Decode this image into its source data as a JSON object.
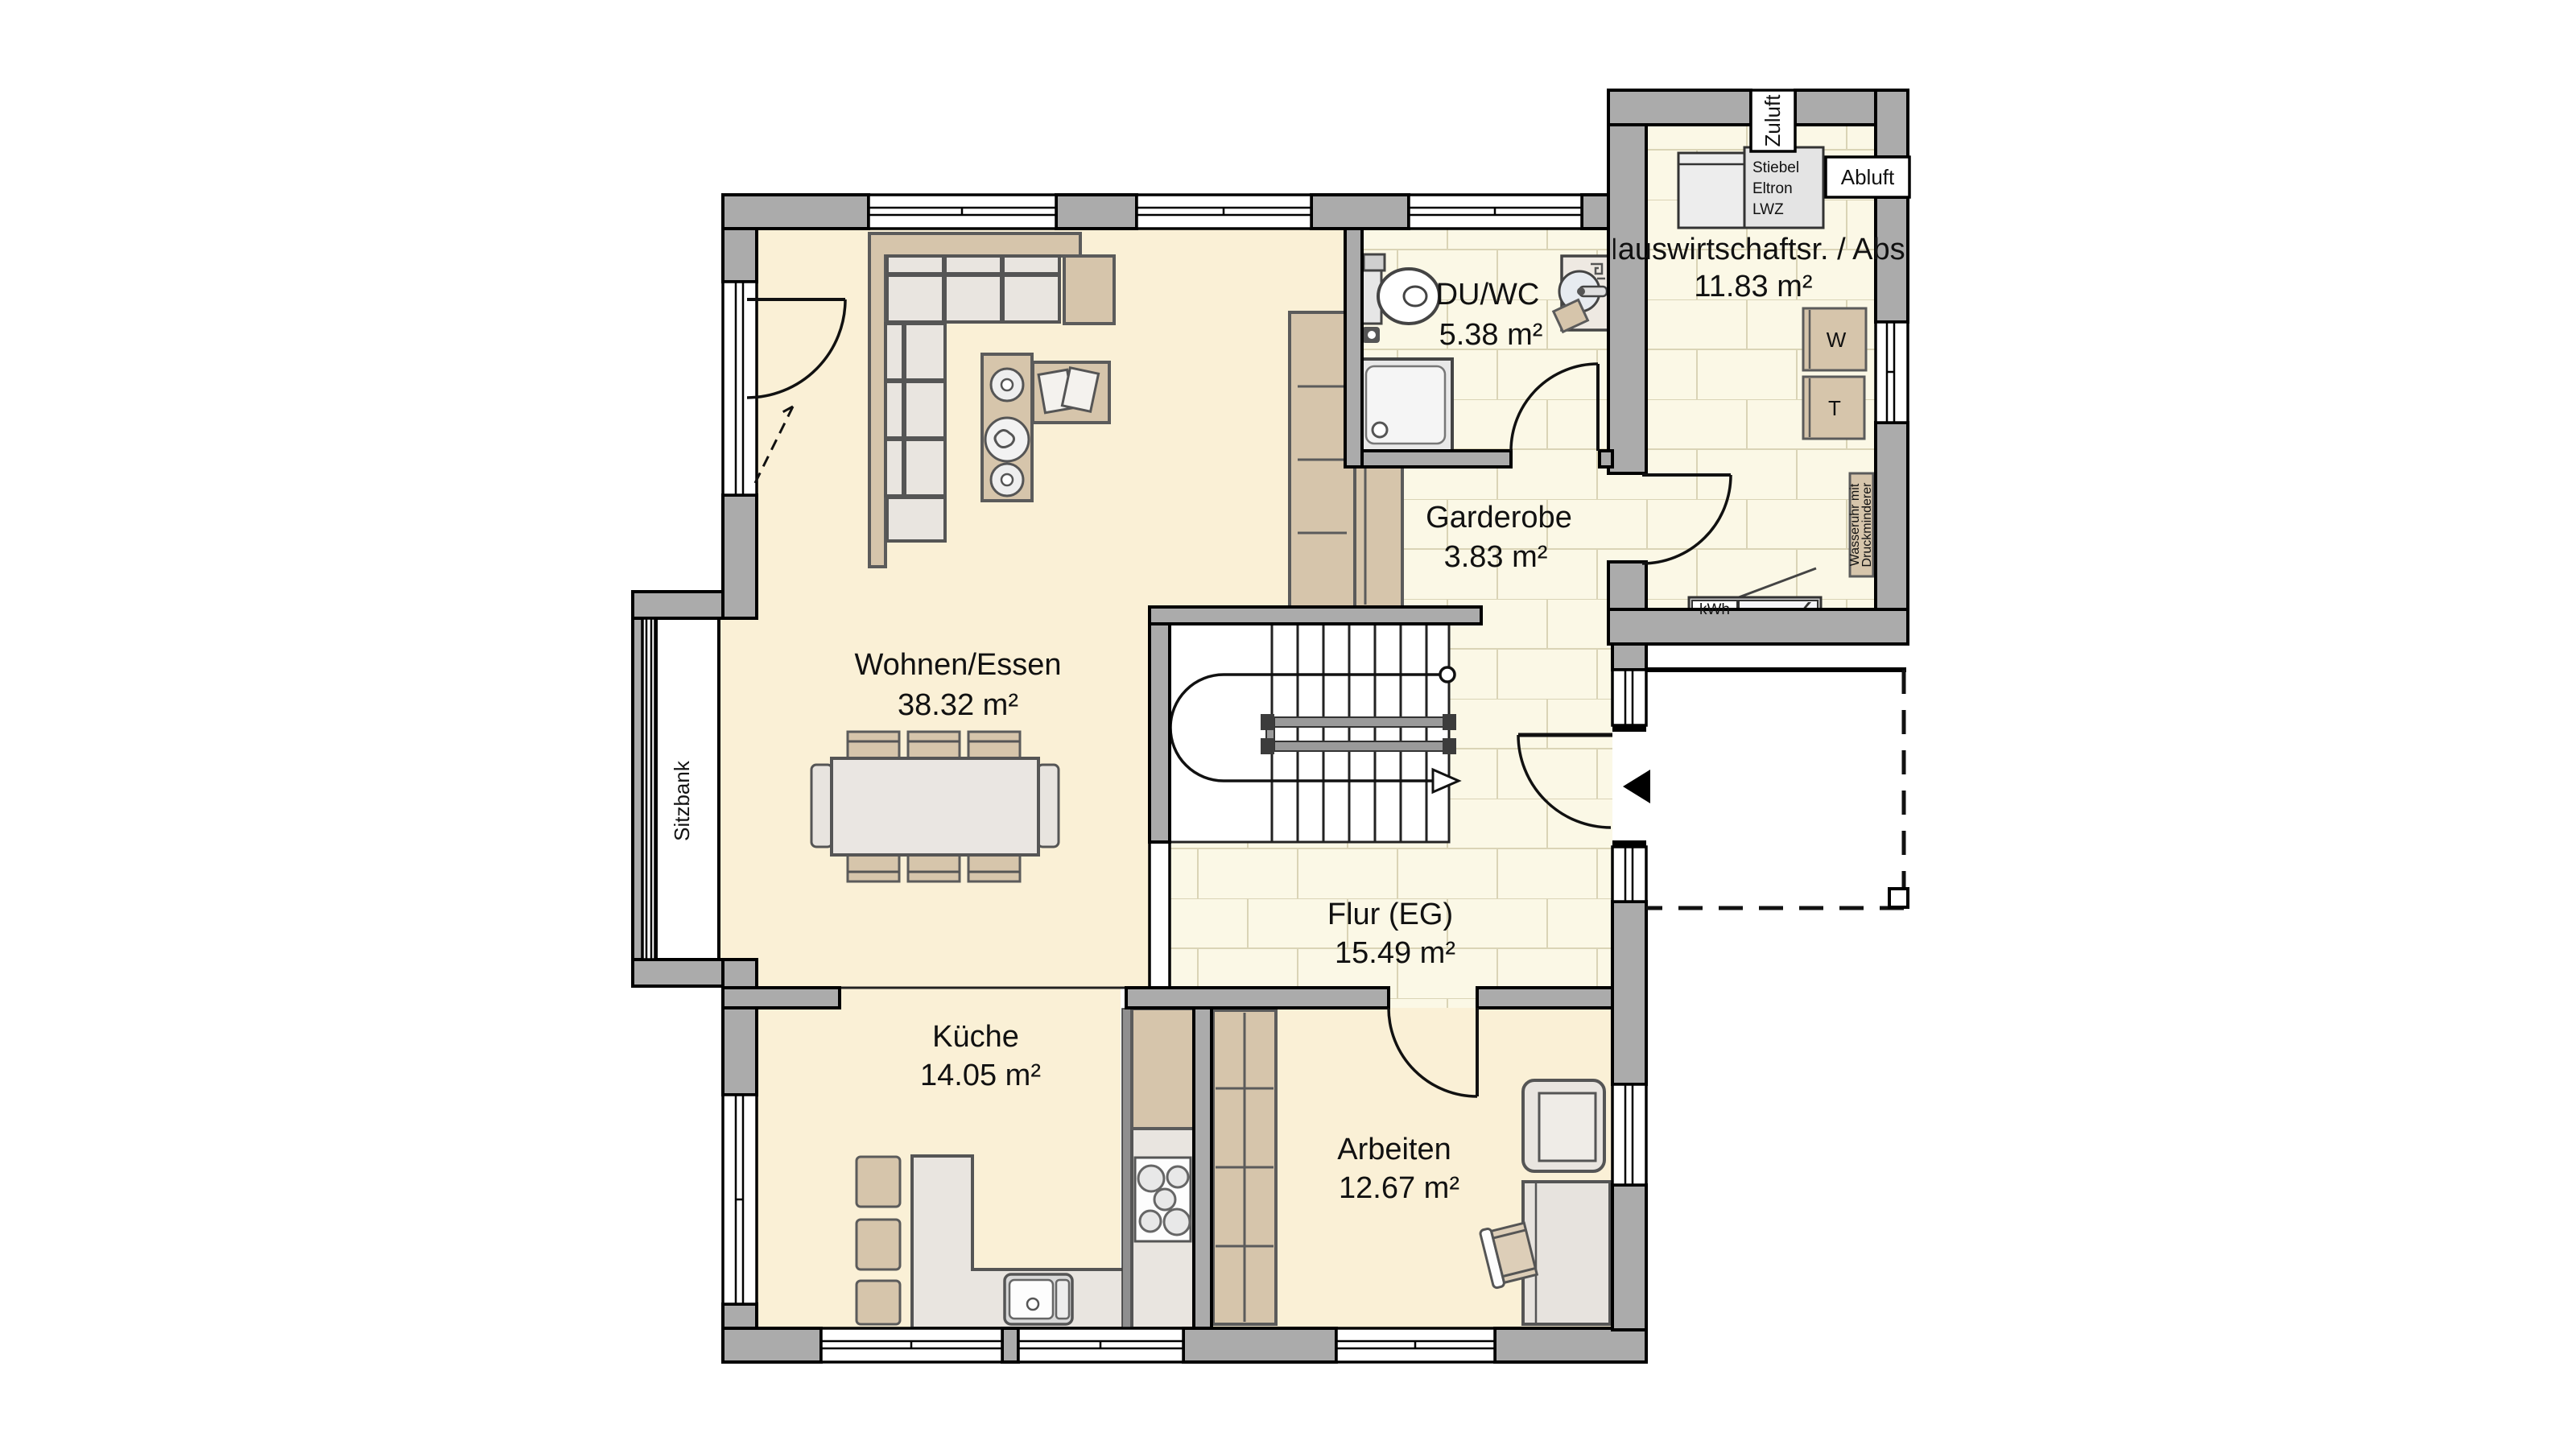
{
  "rooms": [
    {
      "id": "wohnen",
      "name": "Wohnen/Essen",
      "area": "38.32 m²"
    },
    {
      "id": "duwc",
      "name": "DU/WC",
      "area": "5.38 m²"
    },
    {
      "id": "hwr",
      "name": "Hauswirtschaftsr. / Abst.",
      "area": "11.83 m²"
    },
    {
      "id": "garderobe",
      "name": "Garderobe",
      "area": "3.83 m²"
    },
    {
      "id": "flur",
      "name": "Flur (EG)",
      "area": "15.49 m²"
    },
    {
      "id": "kueche",
      "name": "Küche",
      "area": "14.05 m²"
    },
    {
      "id": "arbeiten",
      "name": "Arbeiten",
      "area": "12.67 m²"
    }
  ],
  "annotations": {
    "sitzbank": "Sitzbank",
    "zuluft": "Zuluft",
    "abluft": "Abluft",
    "lwz0": "Stiebel",
    "lwz1": "Eltron",
    "lwz2": "LWZ",
    "kwh": "kWh",
    "washer": "W",
    "dryer": "T",
    "wasseruhr0": "Wasseruhr mit",
    "wasseruhr1": "Druckminderer"
  },
  "colors": {
    "wall": "#ABABAB",
    "cream": "#FAF0D6",
    "tile": "#FBF8E6",
    "tileline": "#DAD4B6",
    "tan": "#D6C5AB",
    "light": "#E9E5E0"
  }
}
